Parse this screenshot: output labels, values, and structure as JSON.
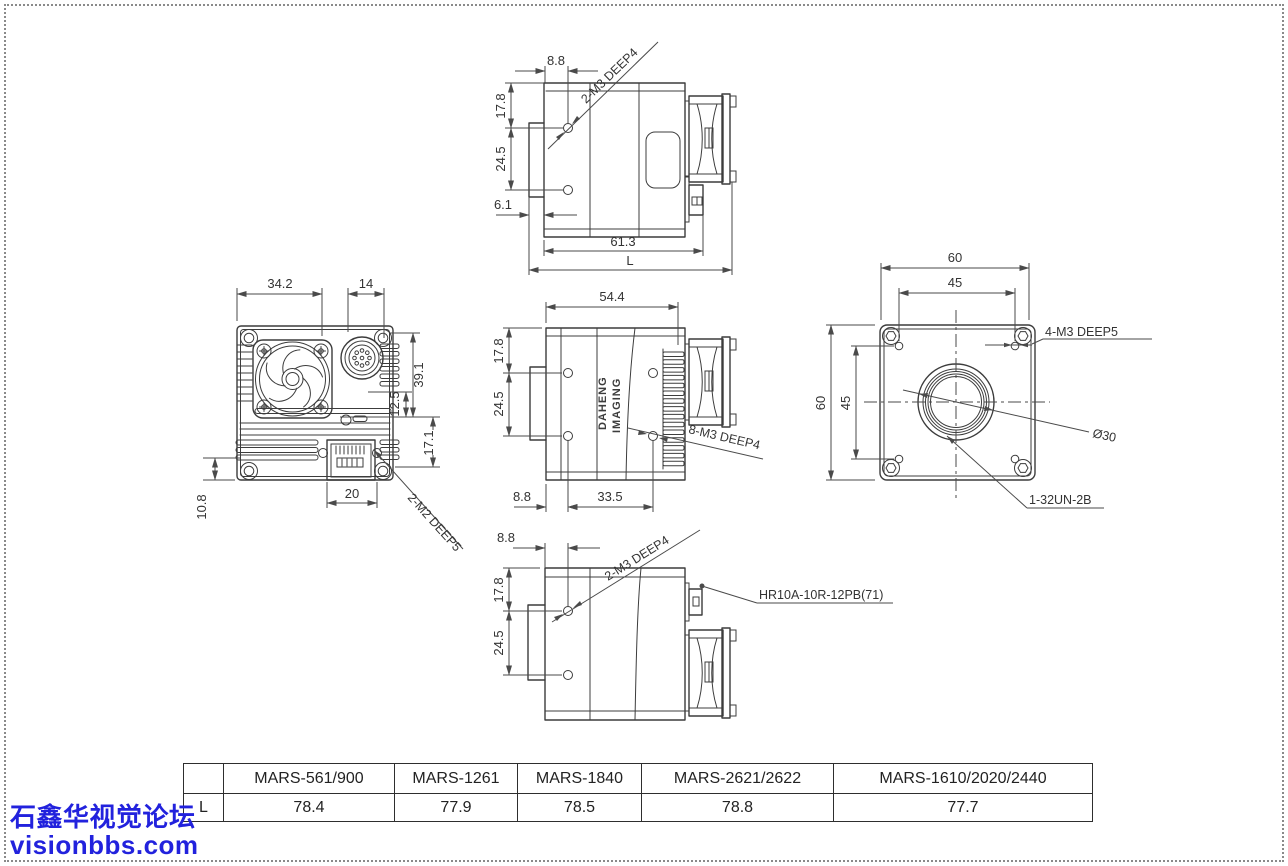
{
  "colors": {
    "line": "#3c3c3c",
    "dimension": "#4a4a4a",
    "watermark_blue": "#2222dd",
    "table_border": "#2e2e2e",
    "page_border_dots": "#8a8a8a"
  },
  "watermark": {
    "line1": "石鑫华视觉论坛",
    "line2": "visionbbs.com"
  },
  "table": {
    "corner": "",
    "row_header": "L",
    "columns": [
      "MARS-561/900",
      "MARS-1261",
      "MARS-1840",
      "MARS-2621/2622",
      "MARS-1610/2020/2440"
    ],
    "values": [
      "78.4",
      "77.9",
      "78.5",
      "78.8",
      "77.7"
    ]
  },
  "views": {
    "top": {
      "dims": {
        "hole_offset": "8.8",
        "top_to_hole": "17.8",
        "hole_spacing": "24.5",
        "flange": "6.1",
        "body_length": "61.3",
        "total_length": "L"
      },
      "callouts": {
        "holes": "2-M3 DEEP4"
      }
    },
    "back": {
      "dims": {
        "width_left": "34.2",
        "connector_width": "14",
        "height_upper": "39.1",
        "mid": "12.5",
        "height_lower": "17.1",
        "bottom_left": "10.8",
        "rj45_width": "20"
      },
      "callouts": {
        "holes": "2-M2 DEEP5"
      }
    },
    "side": {
      "dims": {
        "length": "54.4",
        "top_to_hole": "17.8",
        "hole_spacing": "24.5",
        "front_to_hole": "8.8",
        "hole_span": "33.5"
      },
      "callouts": {
        "holes": "8-M3 DEEP4"
      },
      "logo": {
        "line1": "DAHENG",
        "line2": "IMAGING"
      }
    },
    "front": {
      "dims": {
        "width": "60",
        "hole_pattern_width": "45",
        "height": "60",
        "hole_pattern_height": "45"
      },
      "callouts": {
        "corner_holes": "4-M3 DEEP5",
        "lens_diameter": "Ø30",
        "lens_thread": "1-32UN-2B"
      }
    },
    "bottom": {
      "dims": {
        "hole_offset": "8.8",
        "top_to_hole": "17.8",
        "hole_spacing": "24.5"
      },
      "callouts": {
        "holes": "2-M3 DEEP4",
        "connector": "HR10A-10R-12PB(71)"
      }
    }
  }
}
